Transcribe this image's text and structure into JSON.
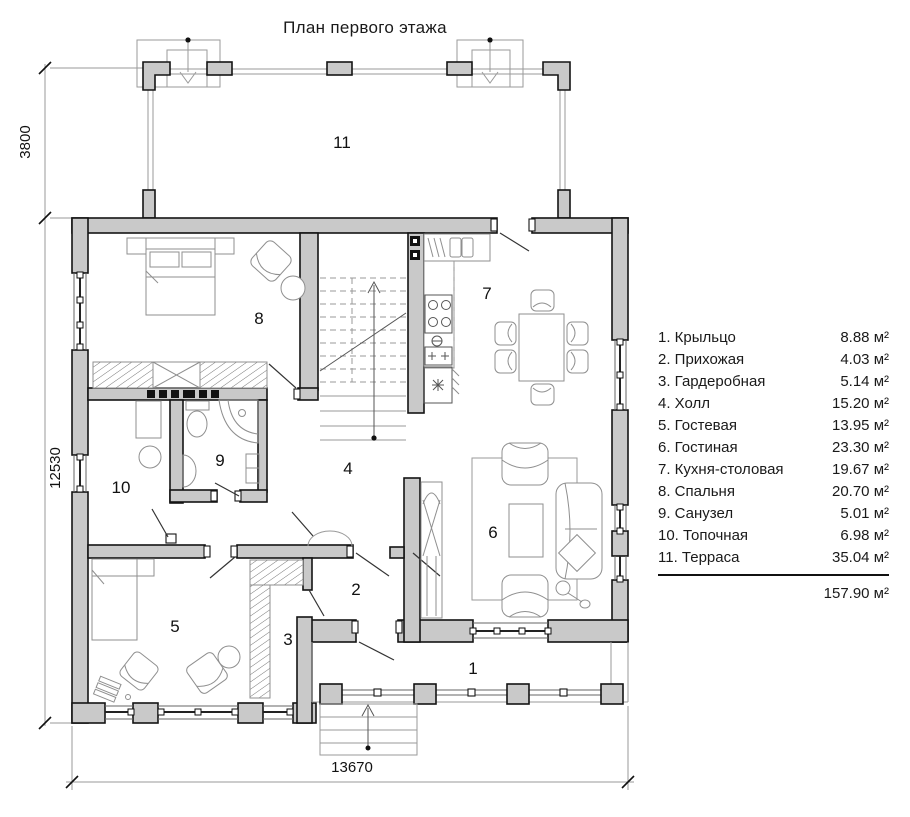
{
  "title": "План первого этажа",
  "dimensions": {
    "terrace": "3800",
    "side": "12530",
    "width": "13670"
  },
  "rooms": {
    "r1": "1",
    "r2": "2",
    "r3": "3",
    "r4": "4",
    "r5": "5",
    "r6": "6",
    "r7": "7",
    "r8": "8",
    "r9": "9",
    "r10": "10",
    "r11": "11"
  },
  "legend": {
    "items": [
      {
        "label": "1. Крыльцо",
        "area": "8.88 м²"
      },
      {
        "label": "2. Прихожая",
        "area": "4.03 м²"
      },
      {
        "label": "3. Гардеробная",
        "area": "5.14 м²"
      },
      {
        "label": "4. Холл",
        "area": "15.20 м²"
      },
      {
        "label": "5. Гостевая",
        "area": "13.95 м²"
      },
      {
        "label": "6. Гостиная",
        "area": "23.30 м²"
      },
      {
        "label": "7. Кухня-столовая",
        "area": "19.67 м²"
      },
      {
        "label": "8. Спальня",
        "area": "20.70 м²"
      },
      {
        "label": "9. Санузел",
        "area": "5.01 м²"
      },
      {
        "label": "10. Топочная",
        "area": "6.98 м²"
      },
      {
        "label": "11. Терраса",
        "area": "35.04 м²"
      }
    ],
    "total": "157.90 м²"
  }
}
